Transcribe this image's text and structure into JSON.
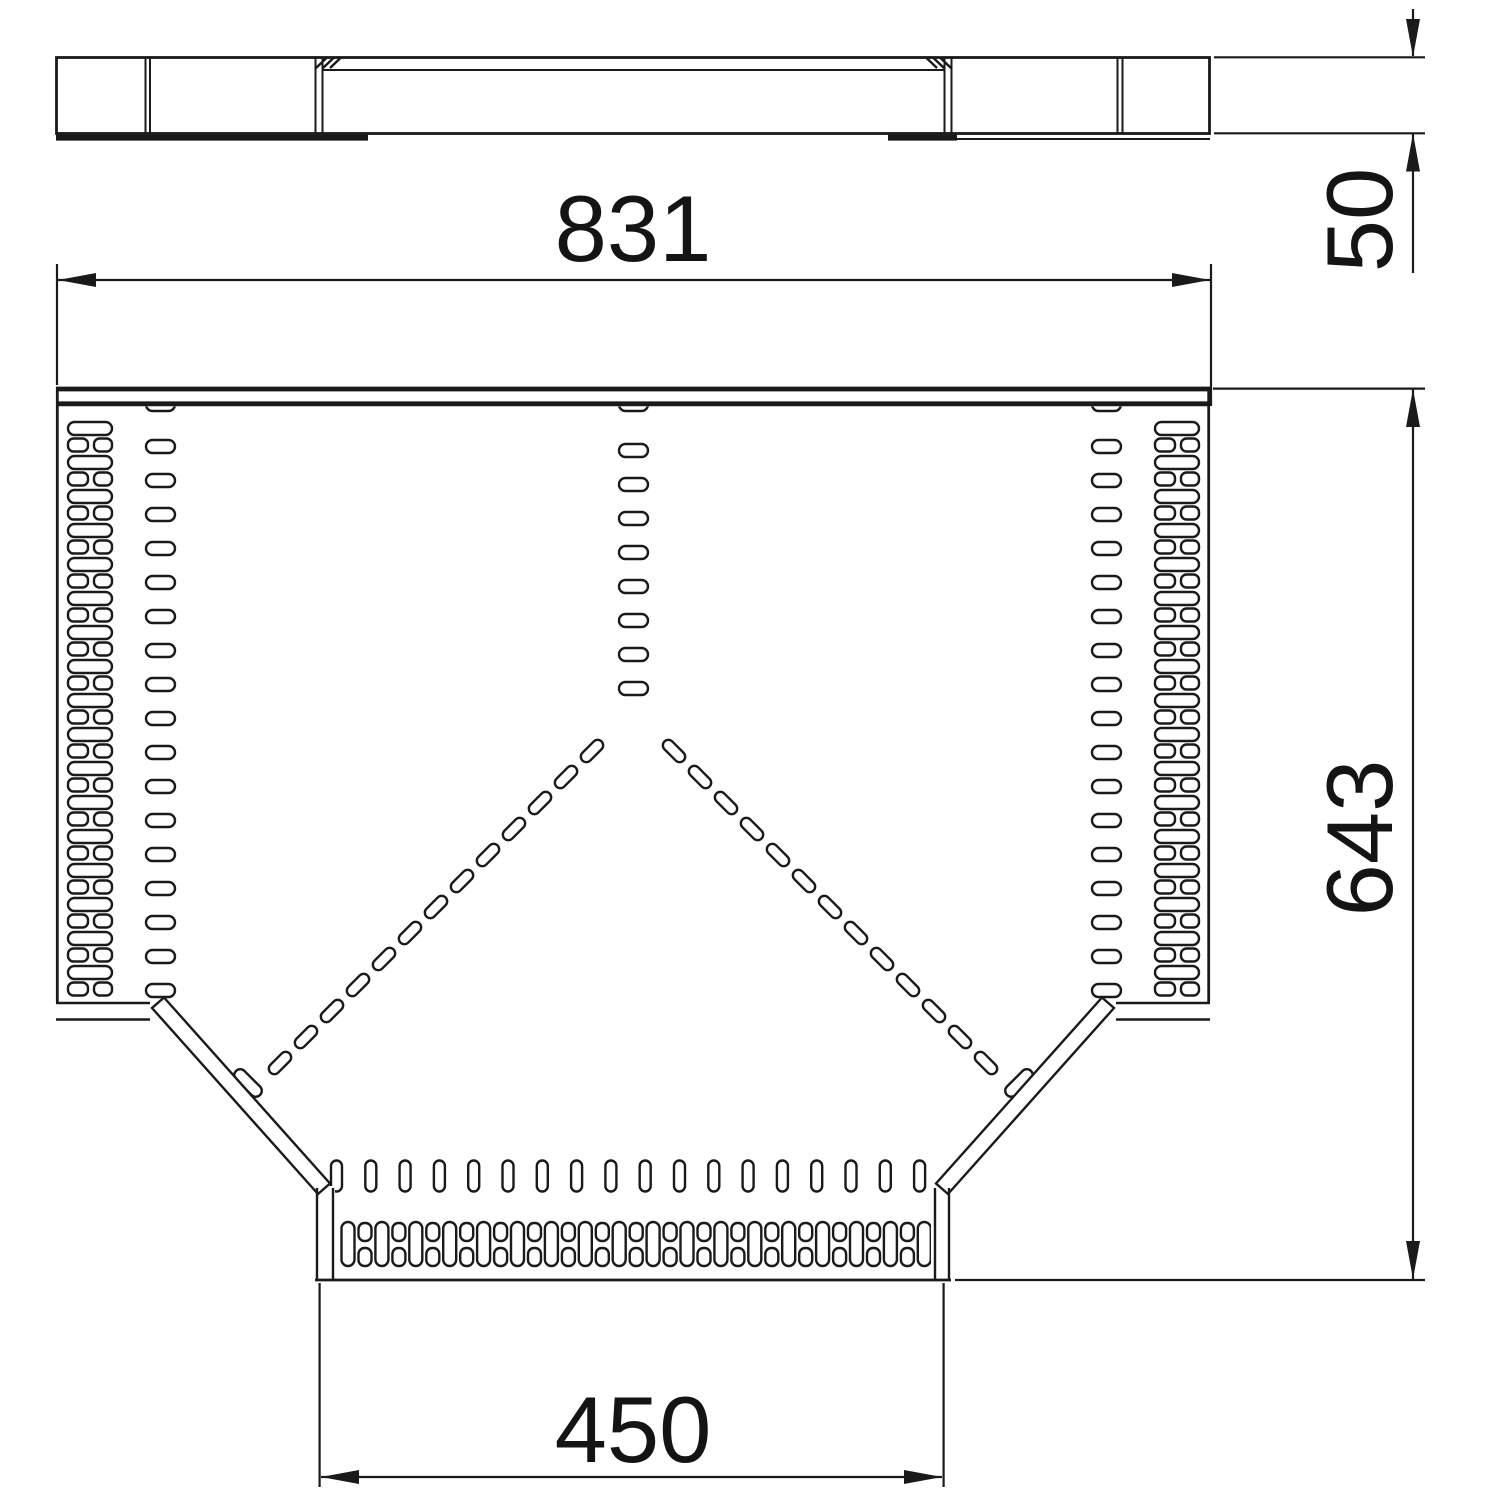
{
  "drawing": {
    "kind": "technical-drawing-t-branch-piece",
    "background_color": "#ffffff",
    "line_color": "#1a1a1a",
    "views": {
      "side_view": "top elevation with couplers",
      "plan_view": "T-branch top view with perforations"
    },
    "dimensions": {
      "overall_width": "831",
      "rail_height": "50",
      "overall_depth": "643",
      "branch_width": "450"
    }
  }
}
